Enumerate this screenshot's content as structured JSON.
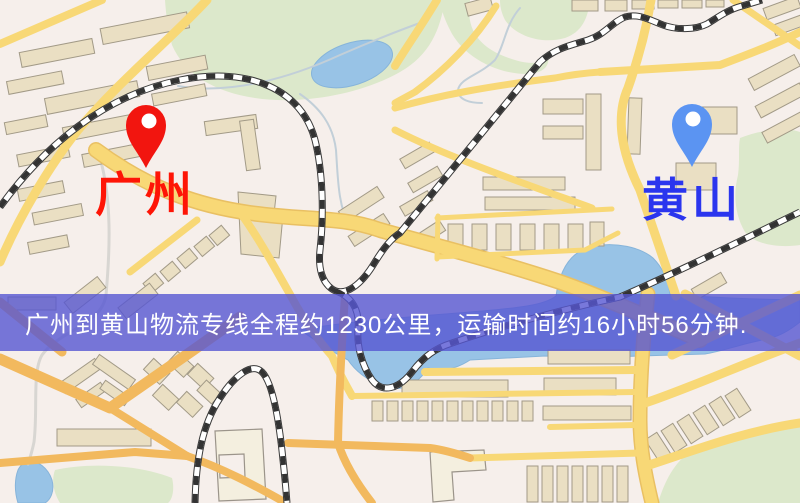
{
  "window": {
    "width": 800,
    "height": 503
  },
  "map": {
    "type": "road-map-with-route-markers",
    "theme_colors": {
      "background": "#f6efeb",
      "road_yellow": "#f8d876",
      "road_orange": "#f2b95e",
      "park_green": "#dce8cb",
      "water_blue": "#98c3e6",
      "building_tan": "#eadfc3",
      "railway": "#383838"
    }
  },
  "markers": {
    "origin": {
      "label": "广州",
      "pin_color": "#f2150f",
      "label_color": "#fe1506"
    },
    "destination": {
      "label": "黄山",
      "pin_color": "#5b94f2",
      "label_color": "#2b35ee"
    }
  },
  "banner": {
    "text": "广州到黄山物流专线全程约1230公里，运输时间约16小时56分钟.",
    "background": "rgba(86,86,210,0.8)",
    "text_color": "#ffffff"
  }
}
